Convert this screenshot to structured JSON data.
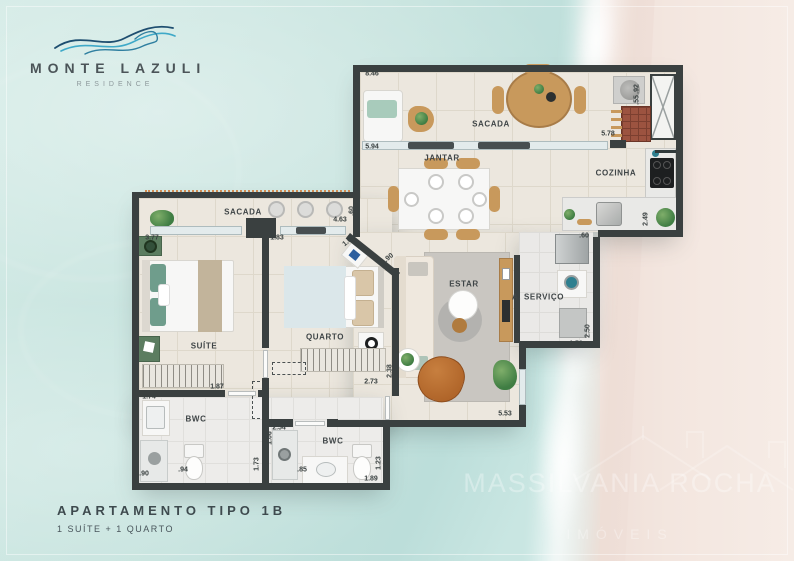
{
  "palette": {
    "wall": "#3a4040",
    "water": "#c6e3de",
    "sand": "#f3e6df",
    "wave_blue_light": "#3fa9c8",
    "wave_blue_dark": "#1e4e70",
    "wave_teal": "#2f7fa0",
    "accent_wood": "#c8995c"
  },
  "logo": {
    "title": "MONTE LAZULI",
    "subtitle": "RESIDENCE"
  },
  "footer": {
    "title": "APARTAMENTO TIPO 1B",
    "subtitle": "1 SUÍTE + 1 QUARTO"
  },
  "watermark": {
    "name": "MASSILVANIA ROCHA",
    "subtitle": "IMÓVEIS"
  },
  "plan": {
    "rooms": [
      {
        "id": "sacada-top",
        "label": "SACADA",
        "x": 491,
        "y": 124
      },
      {
        "id": "jantar",
        "label": "JANTAR",
        "x": 442,
        "y": 158
      },
      {
        "id": "cozinha",
        "label": "COZINHA",
        "x": 616,
        "y": 173
      },
      {
        "id": "estar",
        "label": "ESTAR",
        "x": 464,
        "y": 284
      },
      {
        "id": "servico",
        "label": "A. SERVIÇO",
        "x": 538,
        "y": 297
      },
      {
        "id": "sacada-left",
        "label": "SACADA",
        "x": 243,
        "y": 212
      },
      {
        "id": "suite",
        "label": "SUÍTE",
        "x": 204,
        "y": 346
      },
      {
        "id": "quarto",
        "label": "QUARTO",
        "x": 325,
        "y": 337
      },
      {
        "id": "bwc-suite",
        "label": "BWC",
        "x": 196,
        "y": 419
      },
      {
        "id": "bwc-social",
        "label": "BWC",
        "x": 333,
        "y": 441
      }
    ],
    "dims": [
      {
        "t": "8.46",
        "x": 372,
        "y": 74,
        "r": ""
      },
      {
        "t": "1.43",
        "x": 358,
        "y": 82,
        "r": "v"
      },
      {
        "t": "5.94",
        "x": 372,
        "y": 147,
        "r": ""
      },
      {
        "t": "1.00",
        "x": 357,
        "y": 136,
        "r": "v"
      },
      {
        "t": ".92",
        "x": 637,
        "y": 89,
        "r": "v"
      },
      {
        "t": ".55",
        "x": 637,
        "y": 100,
        "r": "v"
      },
      {
        "t": "5.78",
        "x": 608,
        "y": 134,
        "r": ""
      },
      {
        "t": "2.49",
        "x": 646,
        "y": 219,
        "r": "v"
      },
      {
        "t": "4.63",
        "x": 340,
        "y": 220,
        "r": ""
      },
      {
        "t": ".60",
        "x": 352,
        "y": 211,
        "r": "v"
      },
      {
        "t": "1.83",
        "x": 277,
        "y": 238,
        "r": ""
      },
      {
        "t": "3.15",
        "x": 266,
        "y": 248,
        "r": "v"
      },
      {
        "t": "1.04",
        "x": 349,
        "y": 241,
        "r": "d"
      },
      {
        "t": ".90",
        "x": 389,
        "y": 258,
        "r": "d"
      },
      {
        "t": "2.38",
        "x": 390,
        "y": 371,
        "r": "v"
      },
      {
        "t": "2.73",
        "x": 371,
        "y": 382,
        "r": ""
      },
      {
        "t": "5.53",
        "x": 505,
        "y": 414,
        "r": ""
      },
      {
        "t": ".60",
        "x": 584,
        "y": 236,
        "r": ""
      },
      {
        "t": "2.50",
        "x": 588,
        "y": 331,
        "r": "v"
      },
      {
        "t": "1.50",
        "x": 576,
        "y": 344,
        "r": ""
      },
      {
        "t": "3.77",
        "x": 152,
        "y": 238,
        "r": ""
      },
      {
        "t": "1.74",
        "x": 149,
        "y": 397,
        "r": ""
      },
      {
        "t": "1.00",
        "x": 136,
        "y": 406,
        "r": "v"
      },
      {
        "t": ".90",
        "x": 144,
        "y": 474,
        "r": ""
      },
      {
        "t": ".94",
        "x": 183,
        "y": 470,
        "r": ""
      },
      {
        "t": "1.73",
        "x": 257,
        "y": 464,
        "r": "v"
      },
      {
        "t": "2.04",
        "x": 267,
        "y": 395,
        "r": "v"
      },
      {
        "t": "1.87",
        "x": 217,
        "y": 387,
        "r": ""
      },
      {
        "t": "2.54",
        "x": 279,
        "y": 428,
        "r": ""
      },
      {
        "t": "1.06",
        "x": 270,
        "y": 438,
        "r": "v"
      },
      {
        "t": ".85",
        "x": 302,
        "y": 470,
        "r": ""
      },
      {
        "t": "1.23",
        "x": 379,
        "y": 463,
        "r": "v"
      },
      {
        "t": "1.89",
        "x": 371,
        "y": 479,
        "r": ""
      }
    ]
  }
}
